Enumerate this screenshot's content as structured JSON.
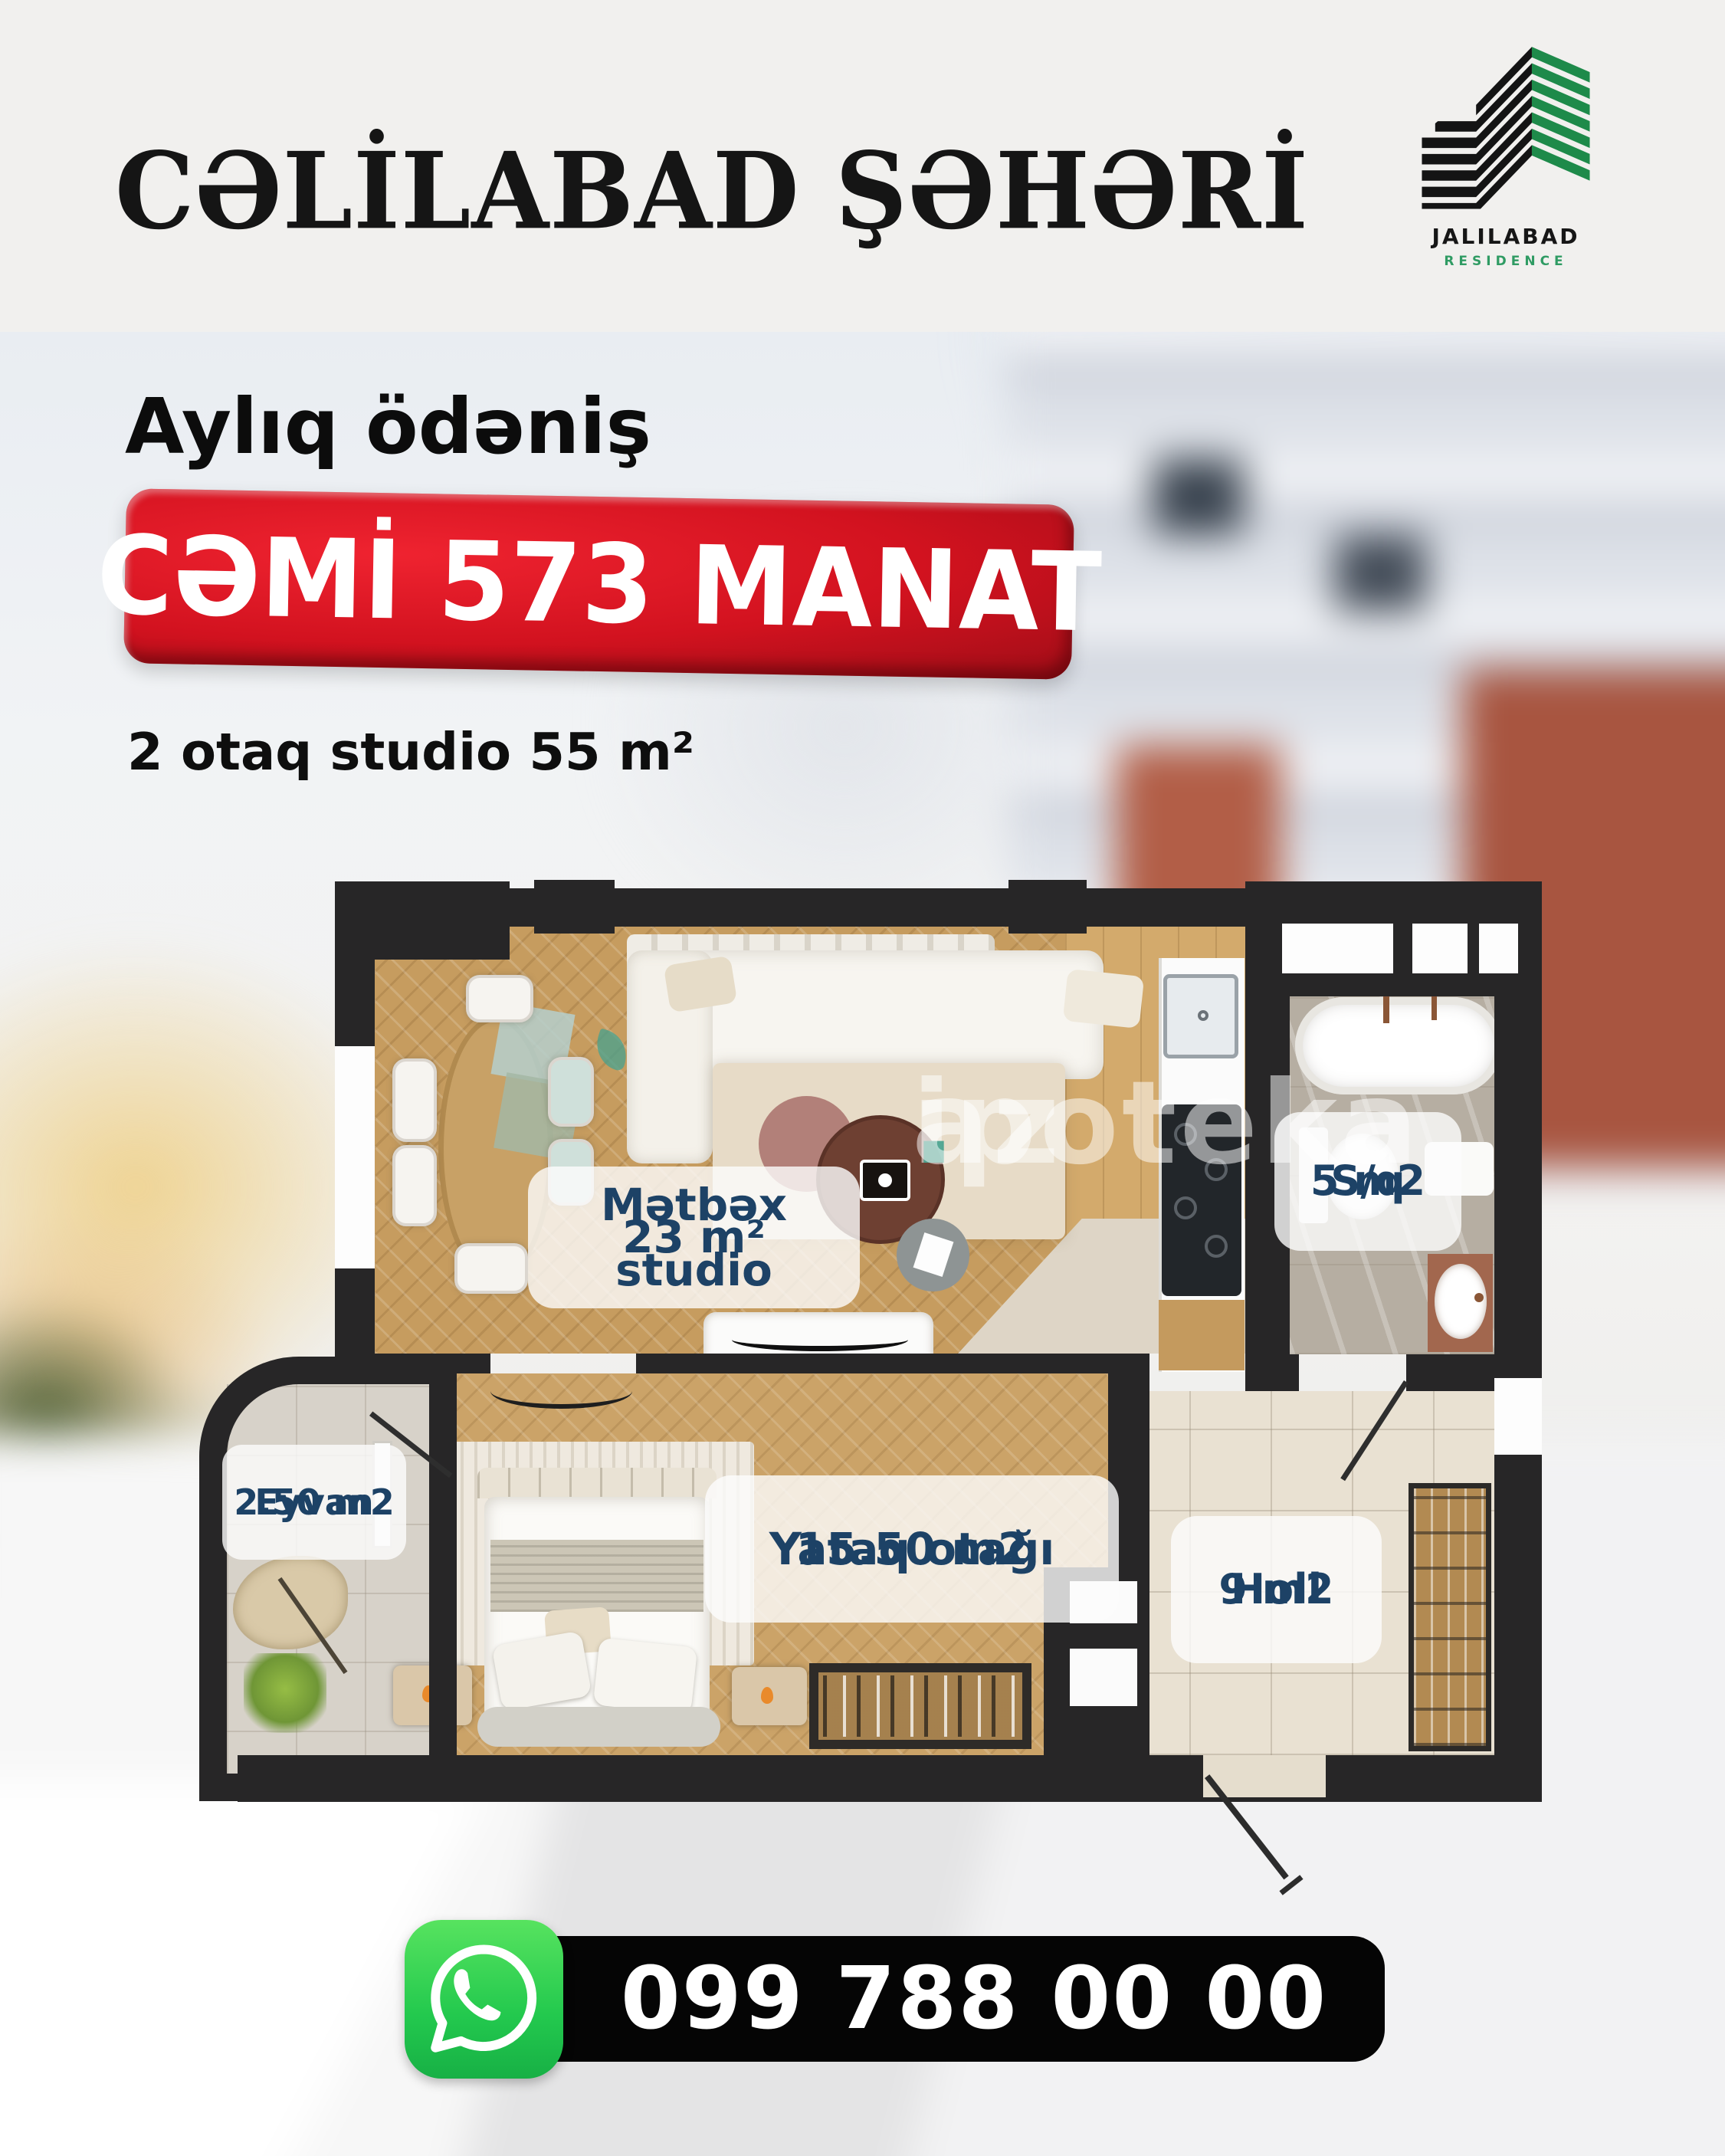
{
  "header": {
    "title": "CƏLİLABAD ŞƏHƏRİ"
  },
  "logo": {
    "brand": "JALILABAD",
    "subtitle": "RESIDENCE",
    "green": "#2f9b63",
    "black": "#161616"
  },
  "offer": {
    "lead": "Aylıq ödəniş",
    "badge": "CƏMİ 573 MANAT",
    "badge_color": "#d2121f",
    "subtitle": "2 otaq studio 55 m²"
  },
  "floorplan": {
    "label_color": "#1d4266",
    "watermark": {
      "name": "ipoteka",
      "dot": ".",
      "tld": "az"
    },
    "rooms": {
      "kitchen": {
        "label": "Mətbəx studio",
        "area": "23 m²"
      },
      "bath": {
        "label": "S/q",
        "area": "5 m2"
      },
      "balcony": {
        "label": "Eyvan",
        "area": "2.50 m2"
      },
      "bedroom": {
        "label": "Yataq otağı",
        "area": "15.50 m2"
      },
      "hall": {
        "label": "Holl",
        "area": "9 m2"
      }
    }
  },
  "contact": {
    "phone": "099 788 00 00",
    "whatsapp_green": "#23c94e"
  }
}
